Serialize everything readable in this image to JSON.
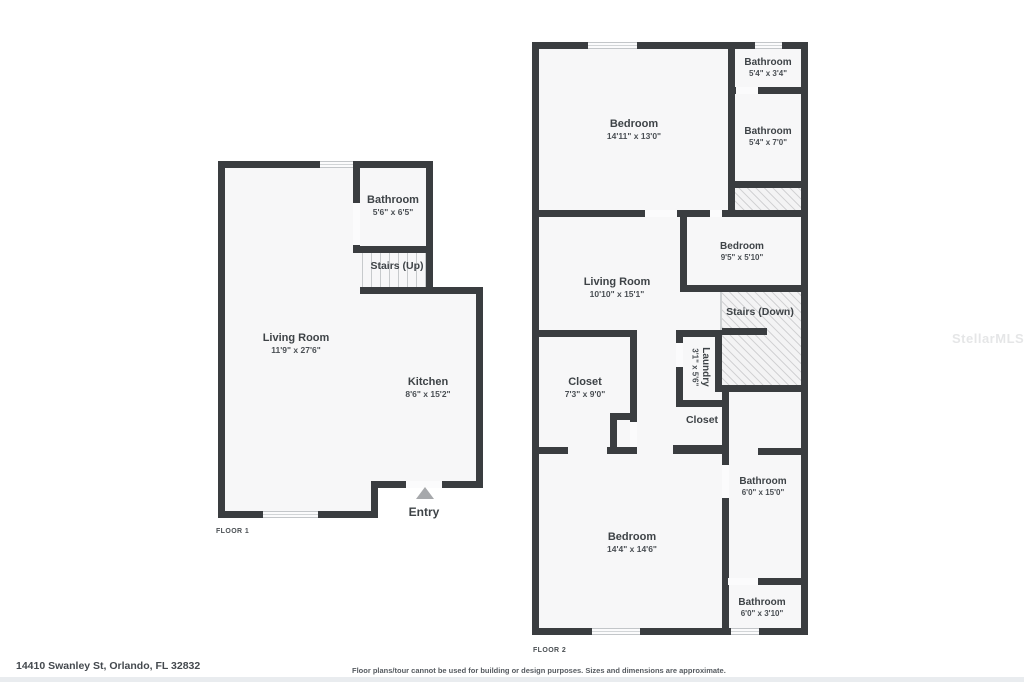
{
  "address": "14410 Swanley St, Orlando, FL 32832",
  "disclaimer": "Floor plans/tour cannot be used for building or design purposes. Sizes and dimensions are approximate.",
  "watermark": "StellarMLS",
  "floor1": {
    "label": "FLOOR 1",
    "rooms": {
      "bathroom": {
        "name": "Bathroom",
        "dims": "5'6\" x 6'5\""
      },
      "stairs": {
        "name": "Stairs (Up)"
      },
      "living": {
        "name": "Living Room",
        "dims": "11'9\" x 27'6\""
      },
      "kitchen": {
        "name": "Kitchen",
        "dims": "8'6\" x 15'2\""
      },
      "entry": {
        "name": "Entry"
      }
    }
  },
  "floor2": {
    "label": "FLOOR 2",
    "rooms": {
      "bedroom1": {
        "name": "Bedroom",
        "dims": "14'11\" x 13'0\""
      },
      "bathroom1": {
        "name": "Bathroom",
        "dims": "5'4\" x 3'4\""
      },
      "bathroom2": {
        "name": "Bathroom",
        "dims": "5'4\" x 7'0\""
      },
      "bedroom2": {
        "name": "Bedroom",
        "dims": "9'5\" x 5'10\""
      },
      "living": {
        "name": "Living Room",
        "dims": "10'10\" x 15'1\""
      },
      "stairs": {
        "name": "Stairs (Down)"
      },
      "closet1": {
        "name": "Closet",
        "dims": "7'3\" x 9'0\""
      },
      "laundry": {
        "name": "Laundry",
        "dims": "3'1\" x 5'6\""
      },
      "closet2": {
        "name": "Closet"
      },
      "bathroom3": {
        "name": "Bathroom",
        "dims": "6'0\" x 15'0\""
      },
      "bedroom3": {
        "name": "Bedroom",
        "dims": "14'4\" x 14'6\""
      },
      "bathroom4": {
        "name": "Bathroom",
        "dims": "6'0\" x 3'10\""
      }
    }
  },
  "colors": {
    "wall": "#3a3d40",
    "floor": "#f7f7f8",
    "hatch": "#f3f3f4"
  }
}
